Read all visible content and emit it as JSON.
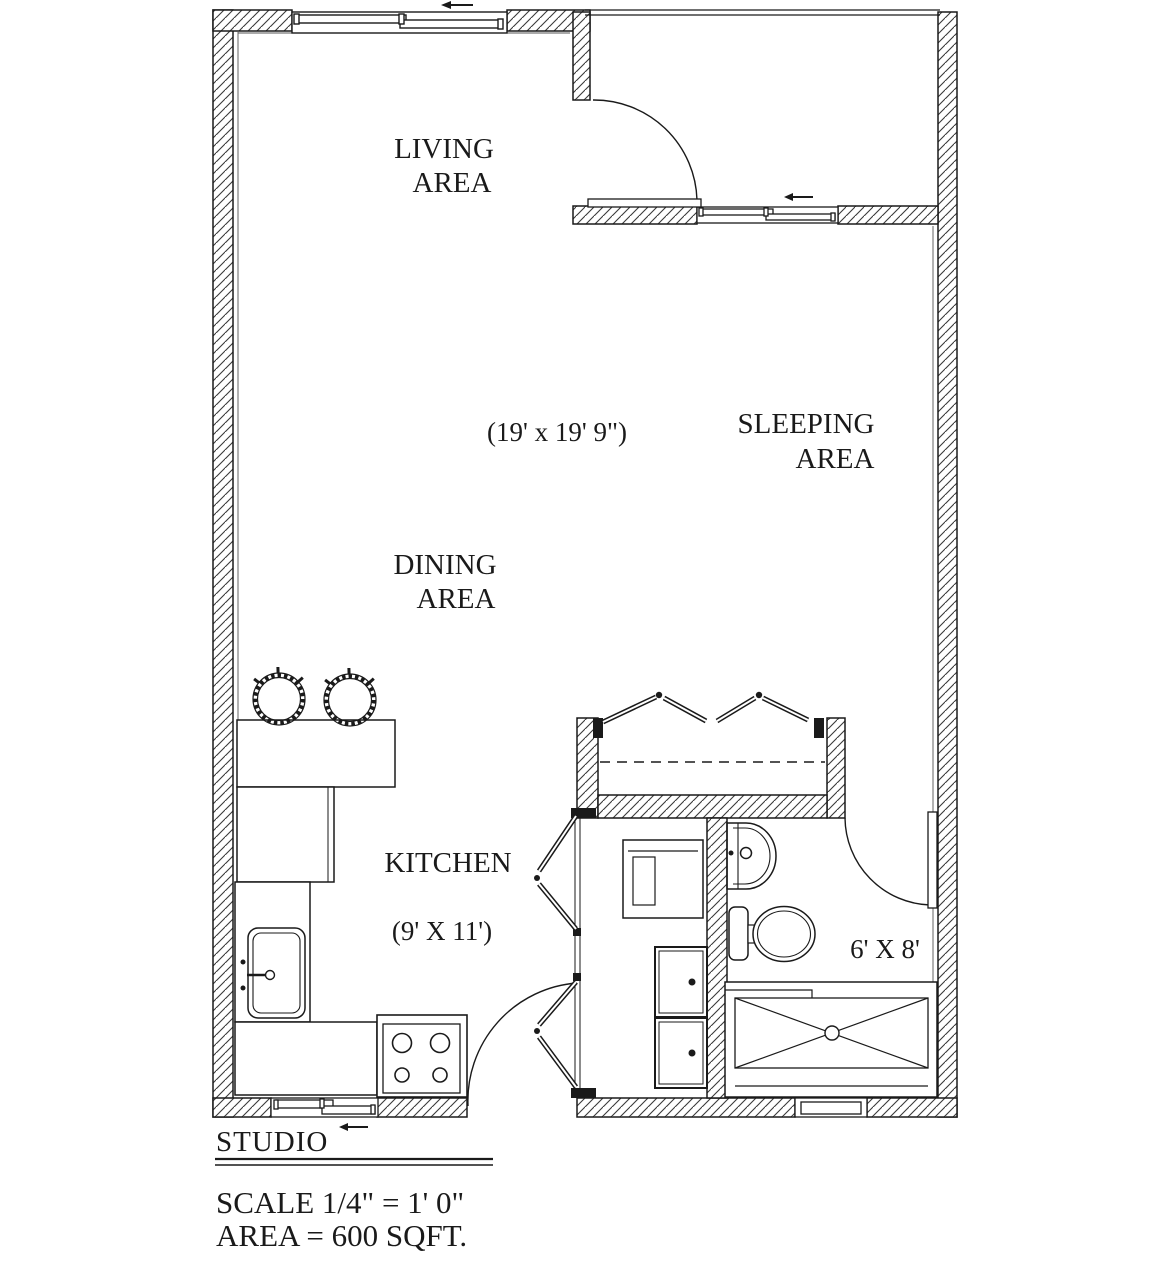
{
  "plan": {
    "rooms": {
      "living": {
        "line1": "LIVING",
        "line2": "AREA"
      },
      "dining": {
        "line1": "DINING",
        "line2": "AREA"
      },
      "sleeping": {
        "line1": "SLEEPING",
        "line2": "AREA"
      },
      "main_dims": "(19' x 19' 9\")",
      "kitchen": {
        "label": "KITCHEN",
        "dims": "(9' X 11')"
      },
      "bathroom": {
        "dims": "6' X 8'"
      }
    },
    "footer": {
      "title": "STUDIO",
      "scale": "SCALE 1/4\" = 1' 0\"",
      "area": "AREA = 600 SQFT."
    },
    "colors": {
      "line": "#1a1a1a",
      "background": "#ffffff"
    }
  }
}
